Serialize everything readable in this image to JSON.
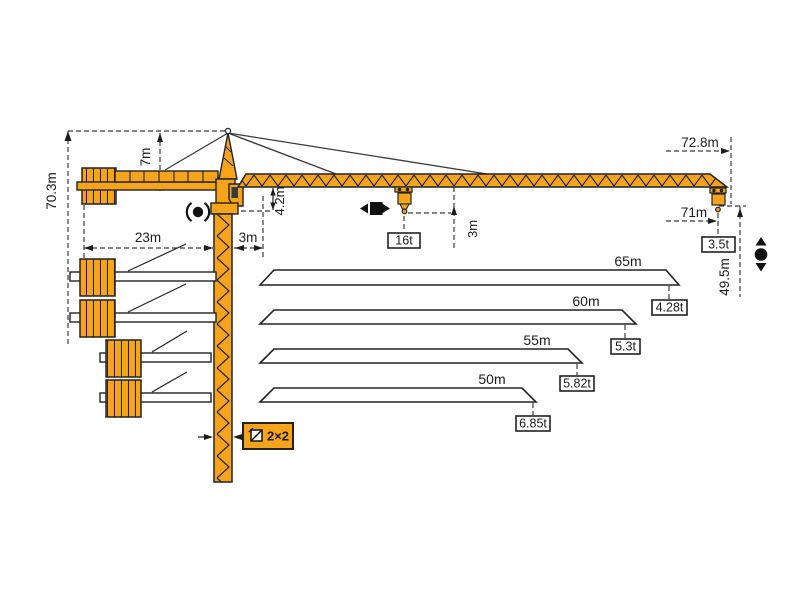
{
  "diagram": {
    "title": "Tower crane working range and dimension diagram",
    "colors": {
      "crane_orange": "#F7A41D",
      "outline": "#2e2e2e",
      "dimension_line": "#3c3c3c",
      "background": "#ffffff"
    },
    "labels": {
      "total_height": "70.3m",
      "tower_head_height": "7m",
      "counterjib_radius": "23m",
      "mast_to_min_trolley": "3m",
      "jib_underside_offset": "4.2m",
      "hook_drop_at_trolley": "3m",
      "max_capacity": "16t",
      "max_radius": "72.8m",
      "tip_hook_radius": "71m",
      "tip_capacity": "3.5t",
      "hook_height": "49.5m",
      "mast_section": "2×2"
    },
    "jib_variants": [
      {
        "length": "65m",
        "tip_capacity": "4.28t"
      },
      {
        "length": "60m",
        "tip_capacity": "5.3t"
      },
      {
        "length": "55m",
        "tip_capacity": "5.82t"
      },
      {
        "length": "50m",
        "tip_capacity": "6.85t"
      }
    ],
    "symbols": {
      "slewing": "rotation around tower axis",
      "trolley_travel": "trolley moves left-right along jib",
      "hoist": "hook moves up-down",
      "mast_section": "square tower cross-section"
    }
  }
}
